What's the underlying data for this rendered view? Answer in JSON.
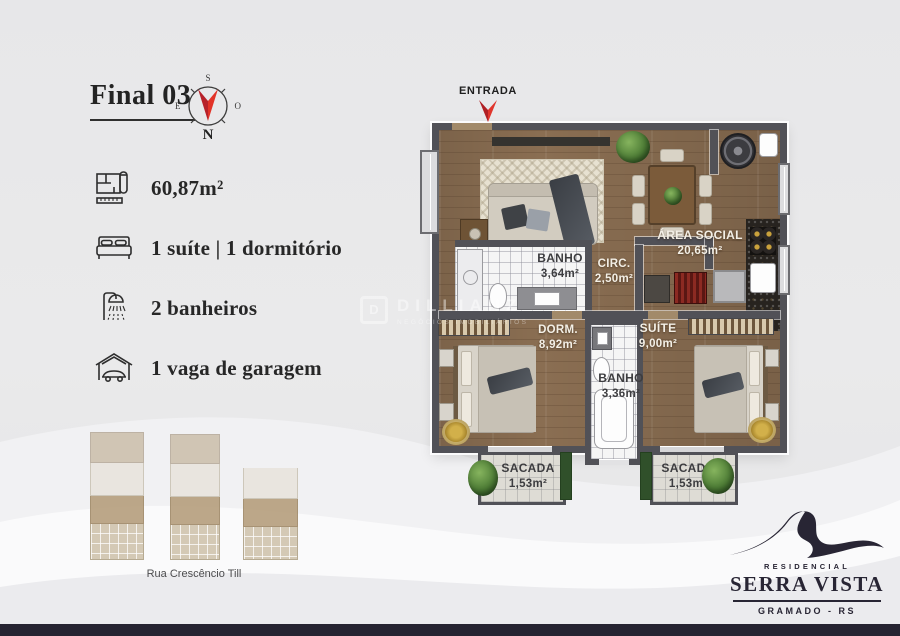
{
  "header": {
    "title": "Final 03"
  },
  "compass": {
    "n": "N",
    "s": "S",
    "e": "E",
    "o": "O"
  },
  "features": [
    {
      "icon": "floorplan-icon",
      "label": "60,87m²"
    },
    {
      "icon": "bed-icon",
      "label": "1 suíte | 1 dormitório"
    },
    {
      "icon": "shower-icon",
      "label": "2 banheiros"
    },
    {
      "icon": "garage-icon",
      "label": "1 vaga de garagem"
    }
  ],
  "plan": {
    "entrance_label": "ENTRADA",
    "rooms": {
      "area_social": {
        "name": "ÁREA SOCIAL",
        "area": "20,65m²"
      },
      "banho_social": {
        "name": "BANHO",
        "area": "3,64m²"
      },
      "circ": {
        "name": "CIRC.",
        "area": "2,50m²"
      },
      "dorm": {
        "name": "DORM.",
        "area": "8,92m²"
      },
      "suite": {
        "name": "SUÍTE",
        "area": "9,00m²"
      },
      "banho_suite": {
        "name": "BANHO",
        "area": "3,36m²"
      },
      "sacada_left": {
        "name": "SACADA",
        "area": "1,53m²"
      },
      "sacada_right": {
        "name": "SACADA",
        "area": "1,53m²"
      }
    }
  },
  "site_plan": {
    "street": "Rua Crescêncio Till"
  },
  "watermark": {
    "brand": "DILLIANZ",
    "tagline": "NEGÓCIOS IMOBILIÁRIOS"
  },
  "logo": {
    "kicker": "RESIDENCIAL",
    "name": "SERRA VISTA",
    "city": "GRAMADO - RS"
  },
  "colors": {
    "accent_red": "#d0342b",
    "navy": "#262331",
    "wood": "#8a6e52"
  }
}
